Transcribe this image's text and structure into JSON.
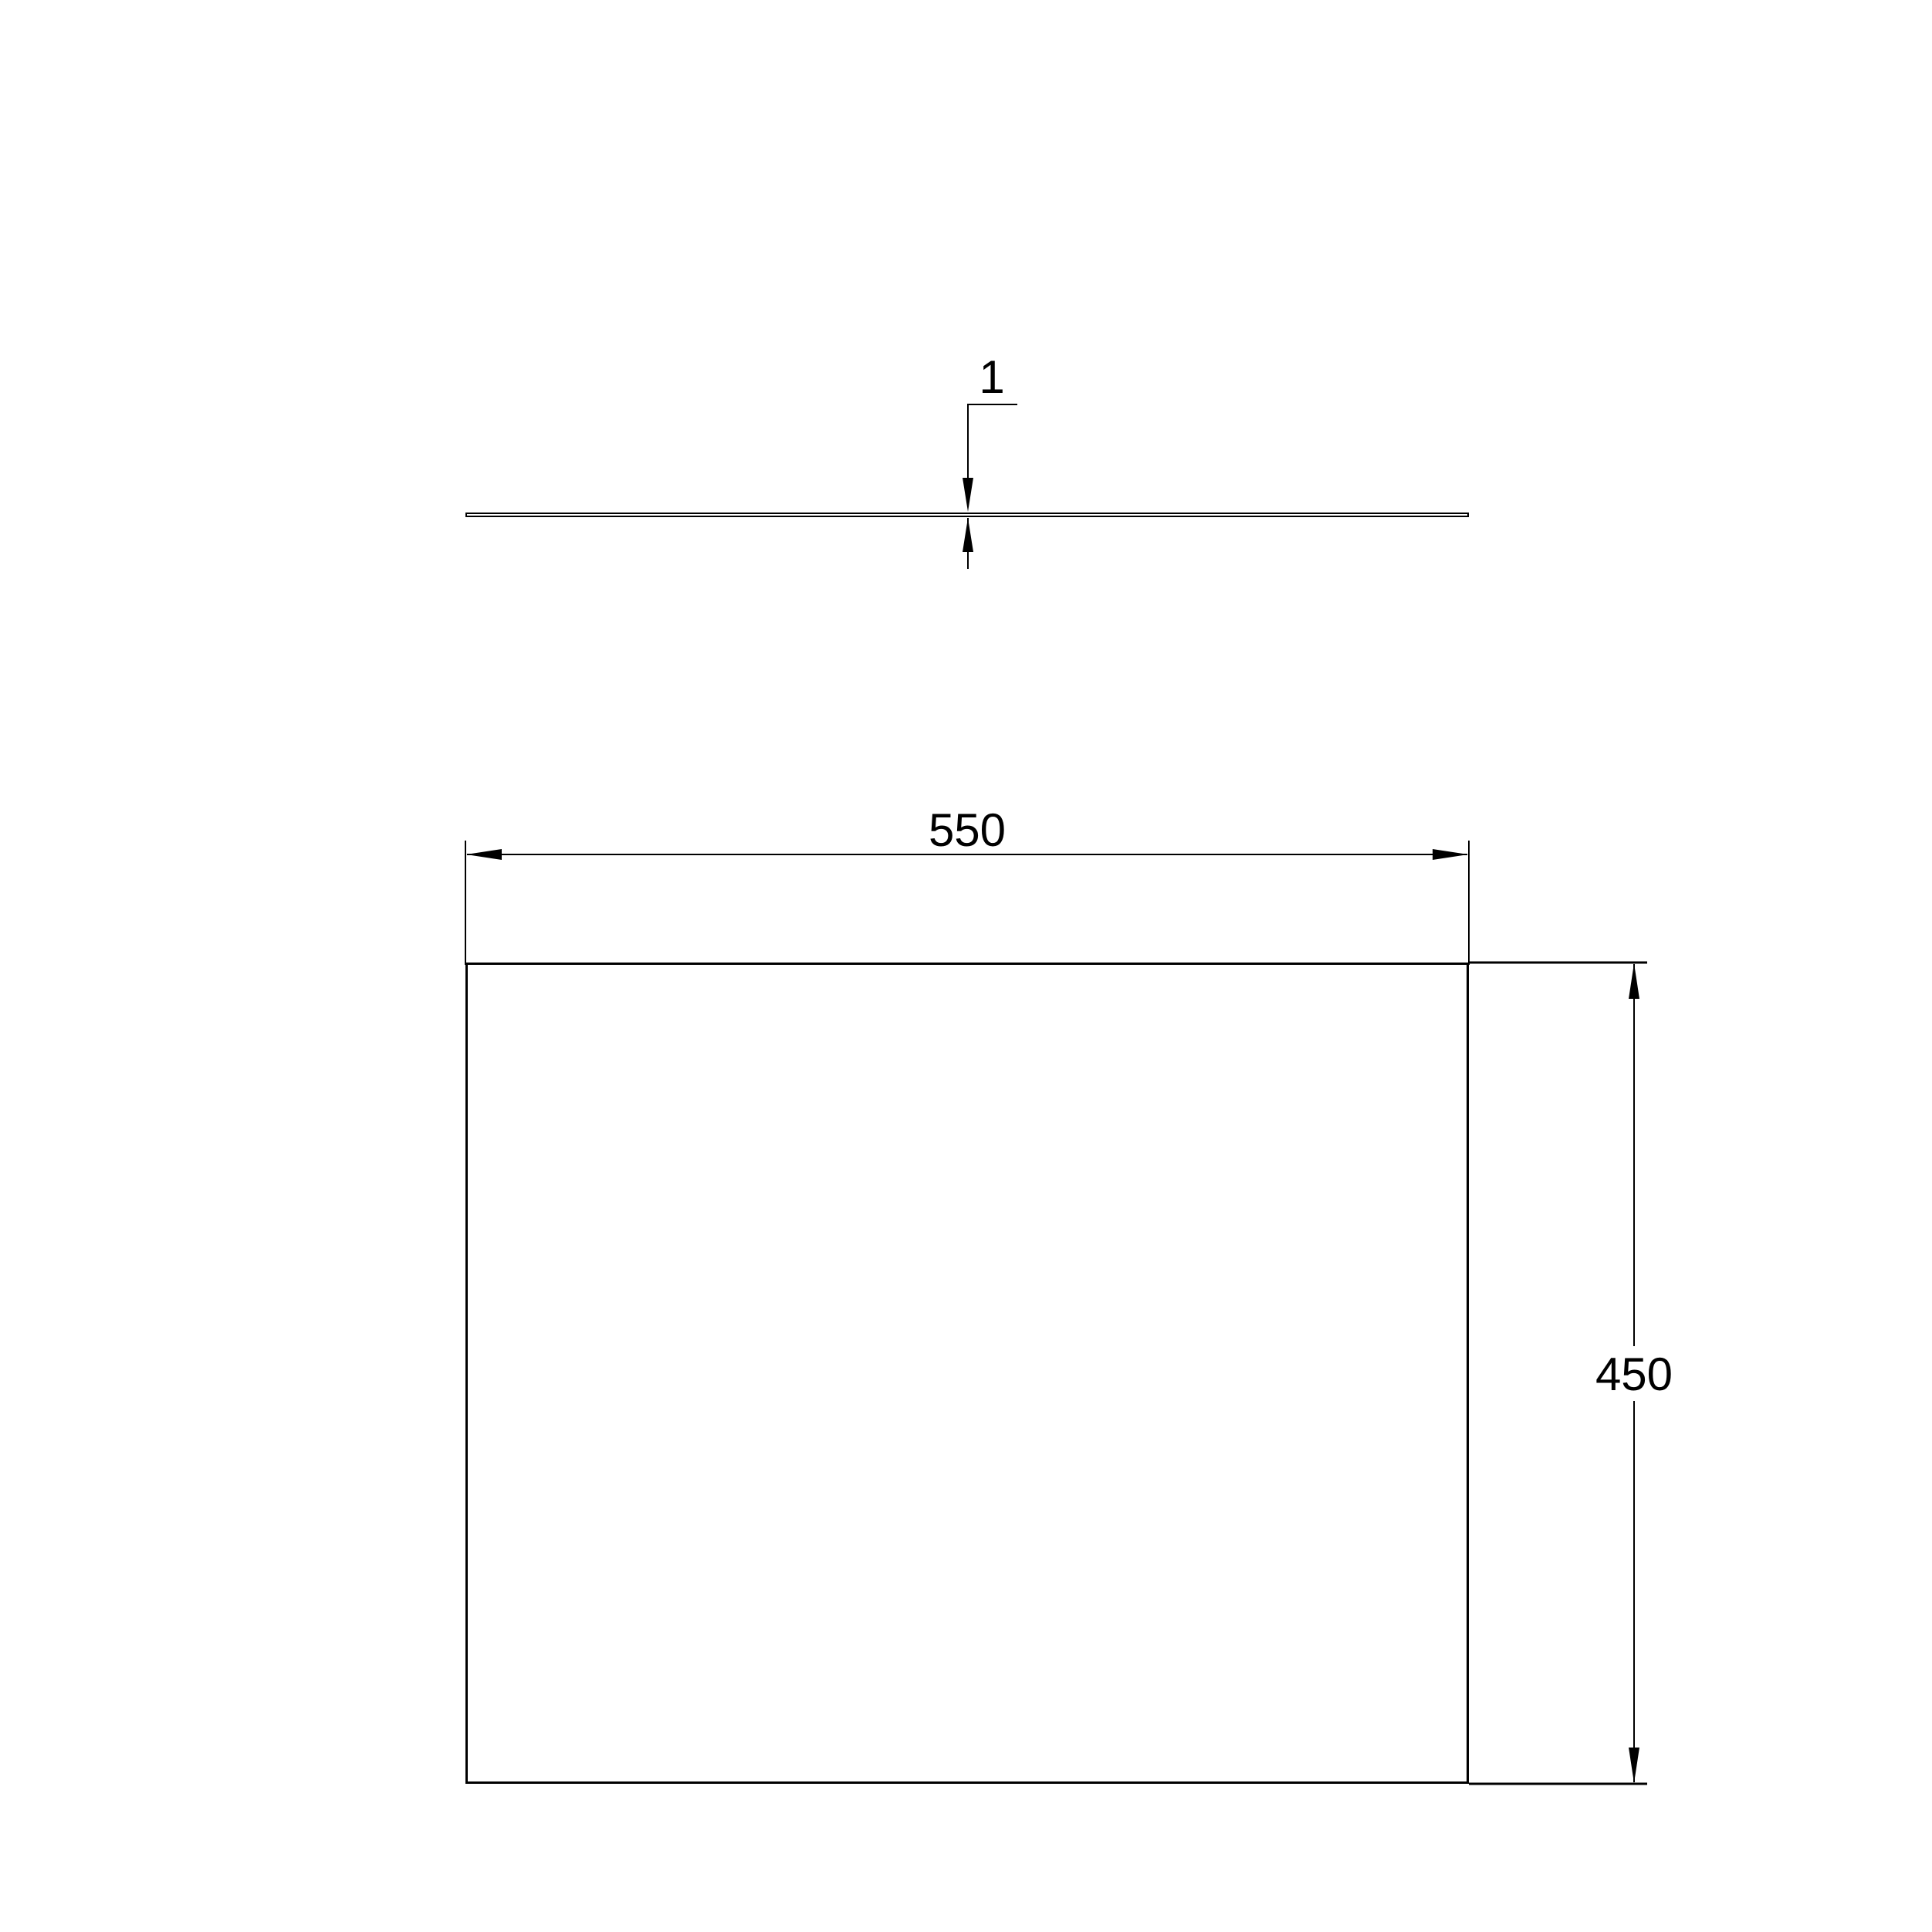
{
  "drawing": {
    "background_color": "#ffffff",
    "line_color": "#000000",
    "dimensions": {
      "thickness": {
        "label": "1",
        "value": 1
      },
      "width": {
        "label": "550",
        "value": 550
      },
      "height": {
        "label": "450",
        "value": 450
      }
    }
  }
}
